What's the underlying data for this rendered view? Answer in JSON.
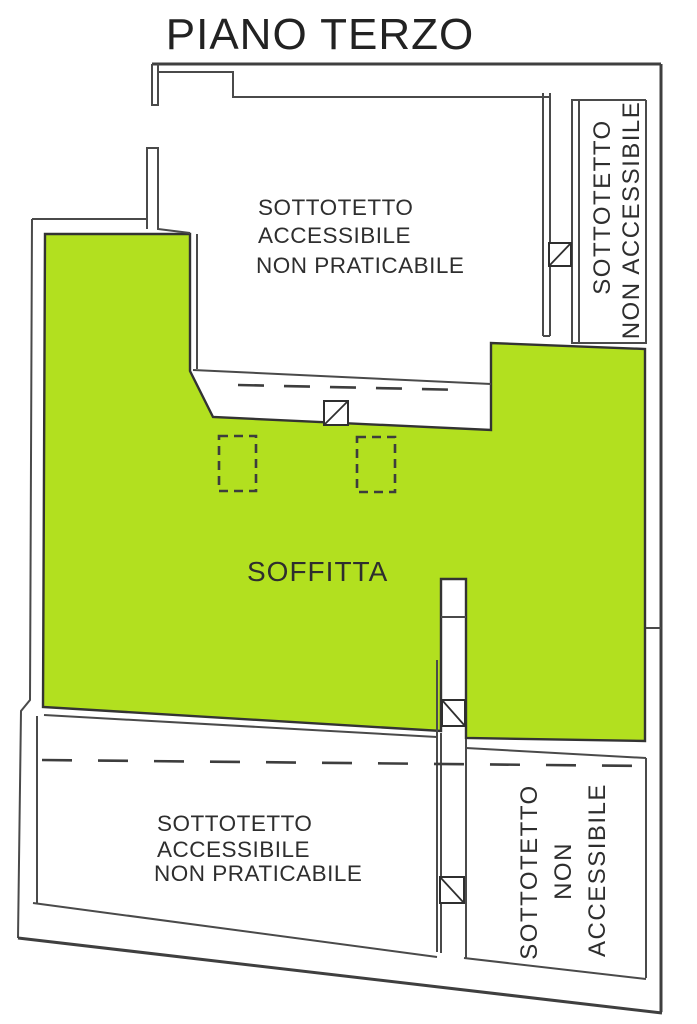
{
  "title": "PIANO TERZO",
  "colors": {
    "soffitta_green": "#b2e01f",
    "wall": "#4a4a4a",
    "text": "#2e2e2e",
    "background": "#ffffff"
  },
  "symbols": {
    "access_hatch": "square-with-diagonal",
    "skylight_opening": "dashed-rectangle",
    "projection_line": "long-dashed-line"
  },
  "rooms": {
    "soffitta": {
      "label": "SOFFITTA"
    },
    "top_attic": {
      "line1": "SOTTOTETTO",
      "line2": "ACCESSIBILE",
      "line3": "NON PRATICABILE"
    },
    "right_strip_attic": {
      "line1": "SOTTOTETTO",
      "line2": "NON ACCESSIBILE"
    },
    "bottom_left_attic": {
      "line1": "SOTTOTETTO",
      "line2": "ACCESSIBILE",
      "line3": "NON PRATICABILE"
    },
    "bottom_right_attic": {
      "line1": "SOTTOTETTO",
      "line2": "NON",
      "line3": "ACCESSIBILE"
    }
  }
}
